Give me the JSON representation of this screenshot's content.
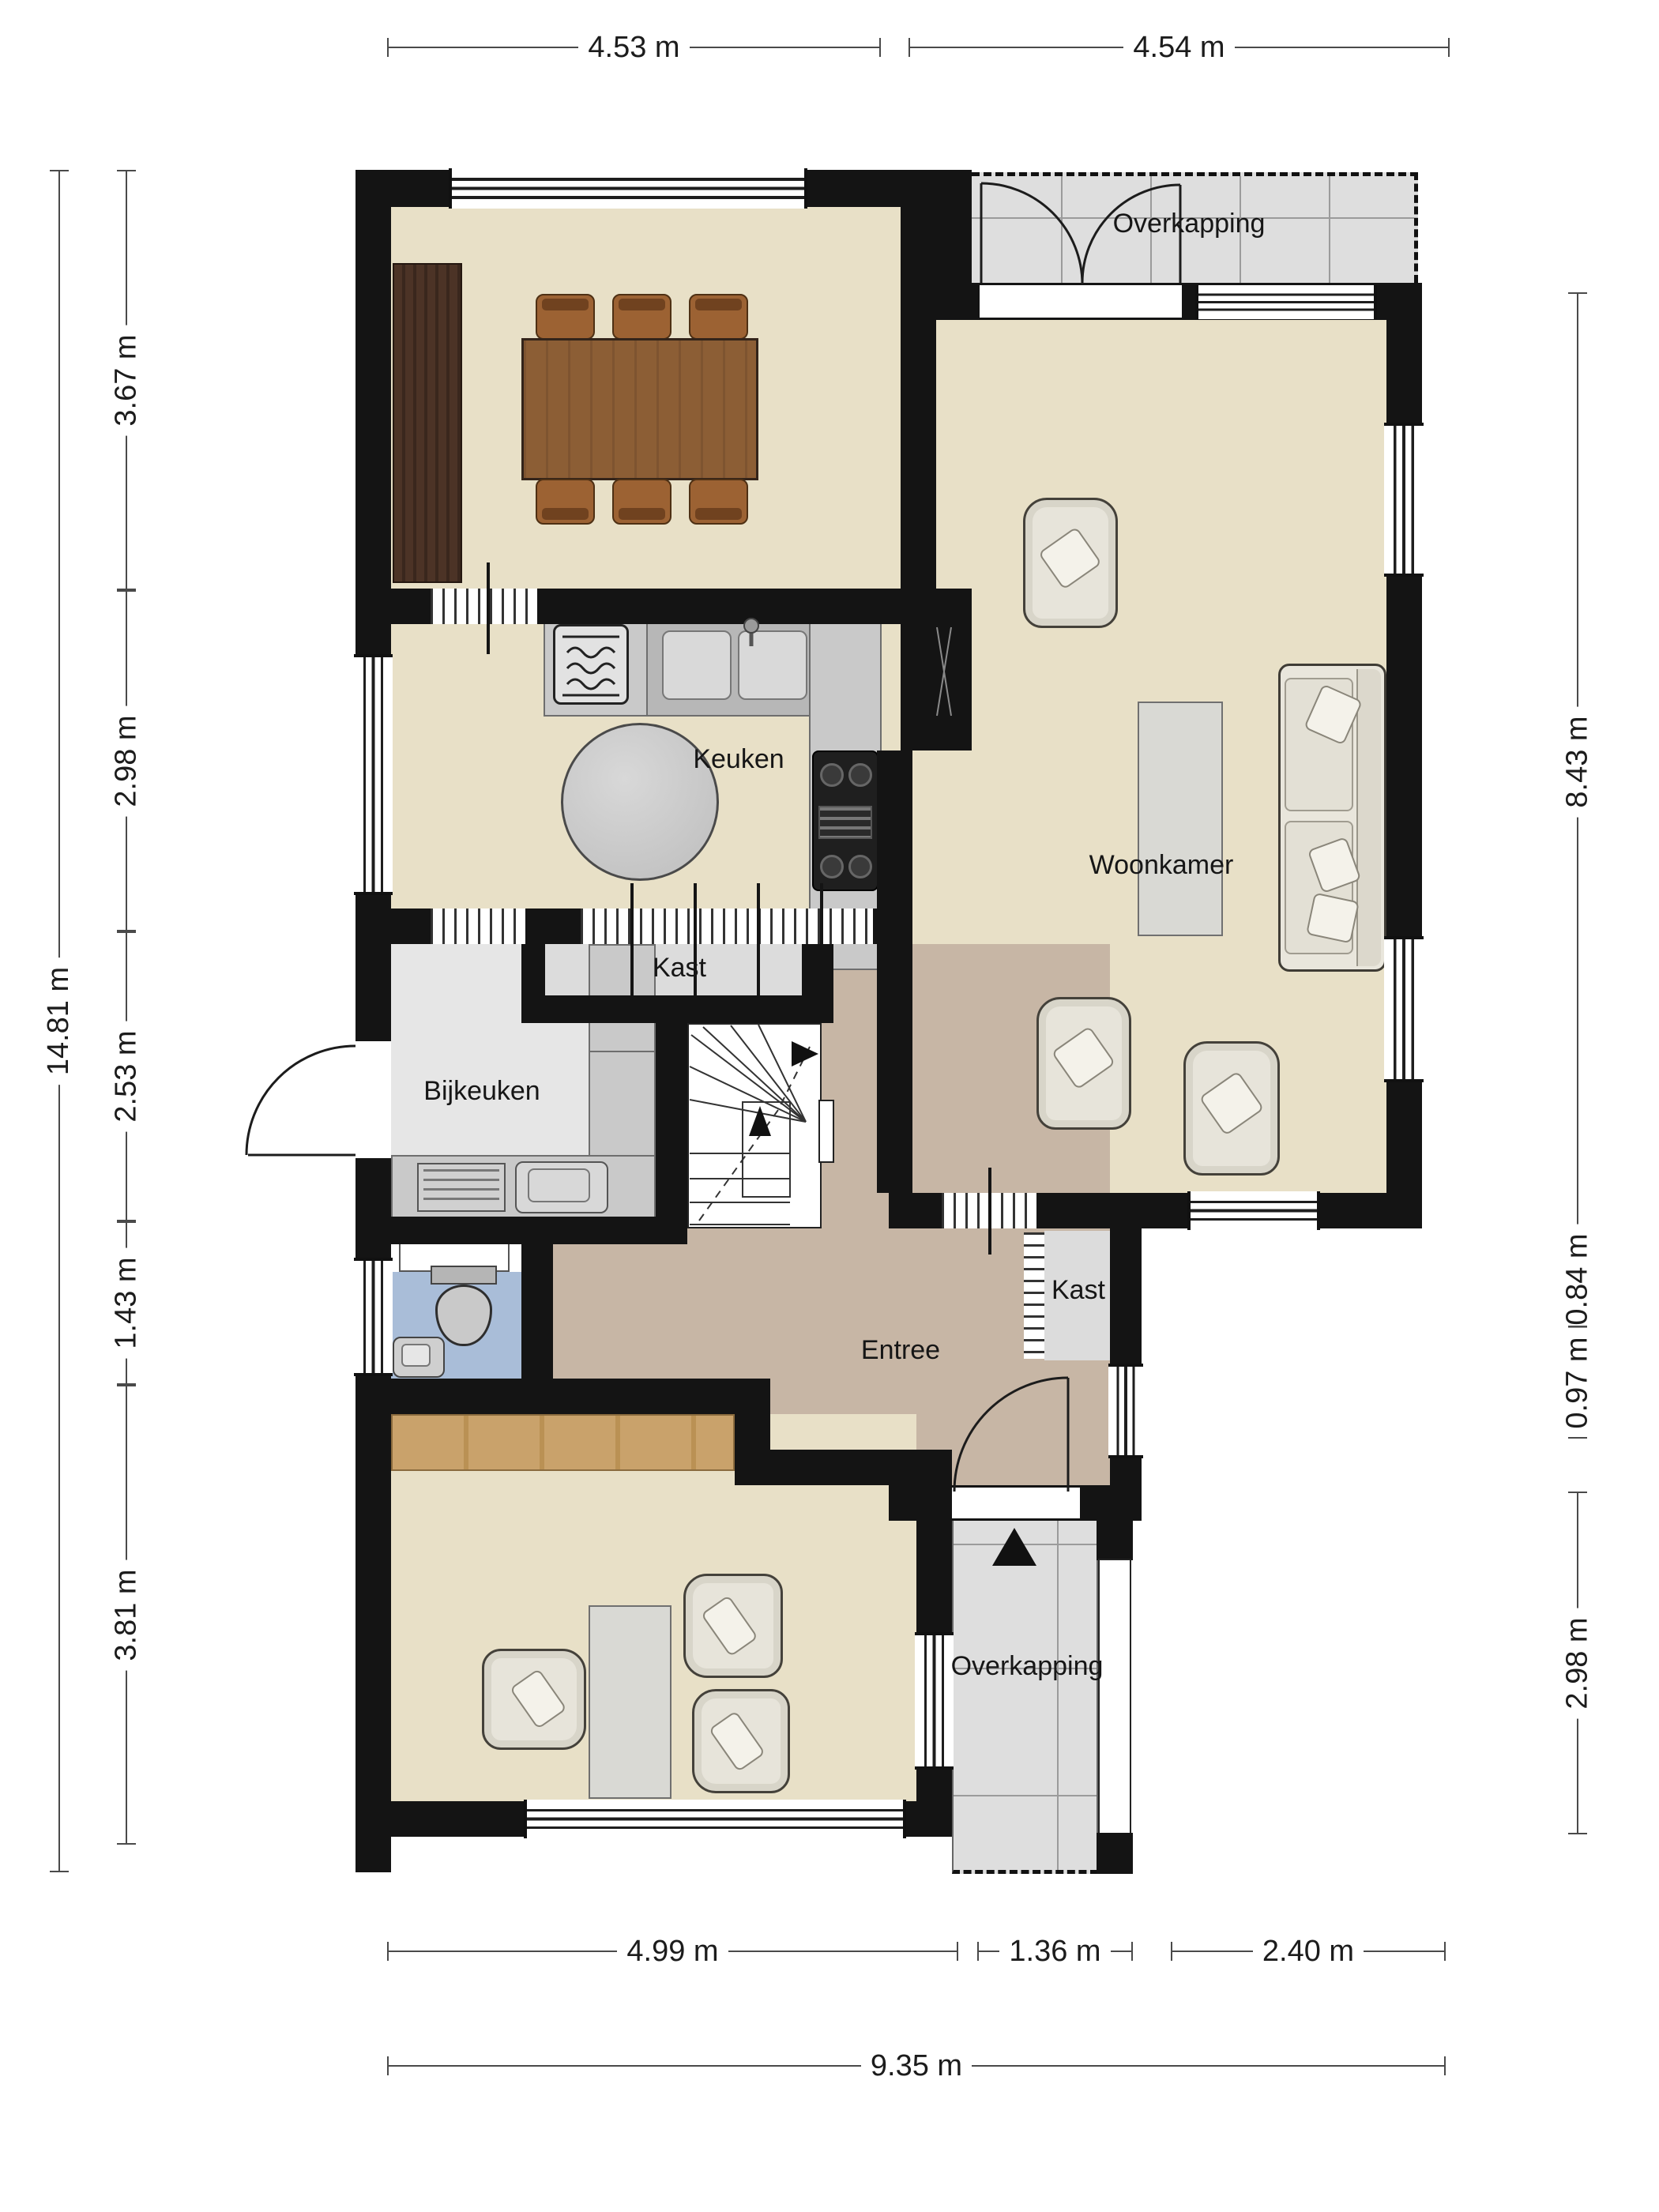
{
  "colors": {
    "wall": "#141414",
    "floor_main": "#e8e0c7",
    "floor_entree": "#c7b6a5",
    "floor_utility": "#e6e6e6",
    "floor_closet": "#dcdcdc",
    "floor_toilet": "#a9bdd8",
    "floor_porch": "#dedede",
    "counter_gray": "#c9c9c9",
    "wood_dark": "#50372a",
    "wood_table": "#8c5e35",
    "wood_light": "#c9a26b",
    "upholstery": "#e9e6dc"
  },
  "dimensions": {
    "top": [
      {
        "label": "4.53 m"
      },
      {
        "label": "4.54 m"
      }
    ],
    "left_total": {
      "label": "14.81 m"
    },
    "left_segments": [
      {
        "label": "3.67 m"
      },
      {
        "label": "2.98 m"
      },
      {
        "label": "2.53 m"
      },
      {
        "label": "1.43 m"
      },
      {
        "label": "3.81 m"
      }
    ],
    "right_segments": [
      {
        "label": "8.43 m"
      },
      {
        "label": "0.84 m"
      },
      {
        "label": "0.97 m"
      },
      {
        "label": "2.98 m"
      }
    ],
    "bottom_segments": [
      {
        "label": "4.99 m"
      },
      {
        "label": "1.36 m"
      },
      {
        "label": "2.40 m"
      }
    ],
    "bottom_total": {
      "label": "9.35 m"
    }
  },
  "rooms": {
    "keuken": {
      "label": "Keuken"
    },
    "woonkamer": {
      "label": "Woonkamer"
    },
    "bijkeuken": {
      "label": "Bijkeuken"
    },
    "entree": {
      "label": "Entree"
    },
    "kast_keuken": {
      "label": "Kast"
    },
    "kast_entree": {
      "label": "Kast"
    },
    "overkapping_top": {
      "label": "Overkapping"
    },
    "overkapping_bottom": {
      "label": "Overkapping"
    }
  }
}
